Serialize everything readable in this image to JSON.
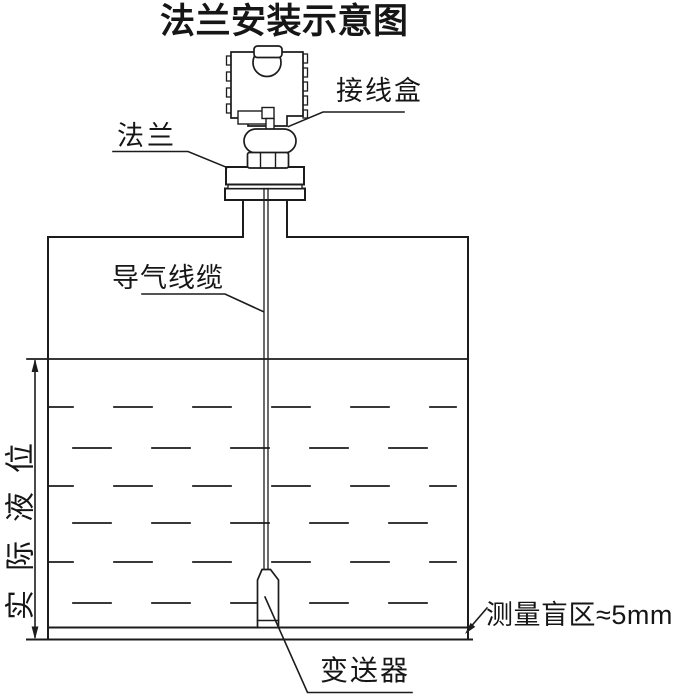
{
  "title": "法兰安装示意图",
  "labels": {
    "junction_box": "接线盒",
    "flange": "法兰",
    "air_cable": "导气线缆",
    "actual_level": "实际液位",
    "transmitter": "变送器",
    "blind_zone": "测量盲区≈5mm"
  },
  "colors": {
    "line": "#1c1c1c",
    "background": "#ffffff"
  }
}
